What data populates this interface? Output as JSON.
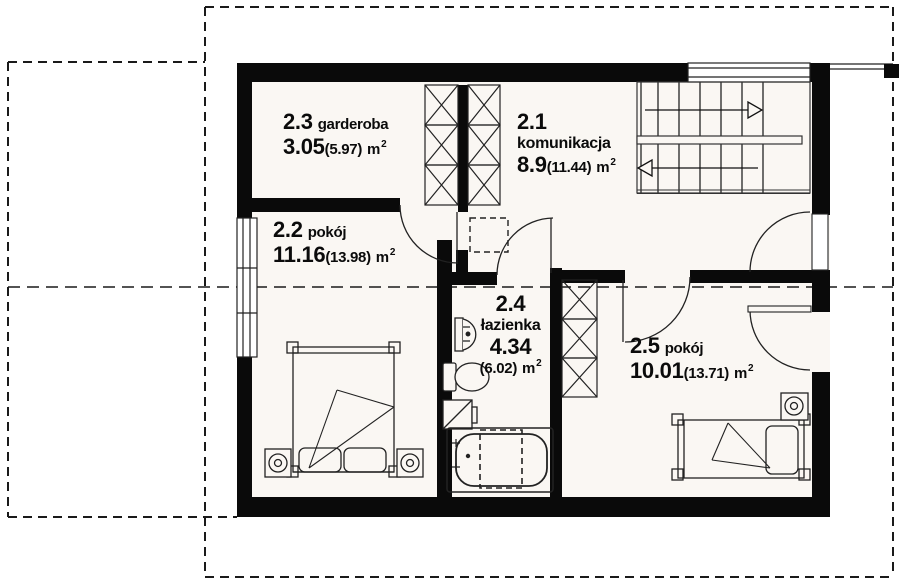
{
  "plan": {
    "title": "first floor plan",
    "unit": {
      "base": "m",
      "sup": "2"
    },
    "rooms": [
      {
        "number": "2.3",
        "name": "garderoba",
        "area": "3.05",
        "area_total": "(5.97)"
      },
      {
        "number": "2.1",
        "name": "komunikacja",
        "area": "8.9",
        "area_total": "(11.44)"
      },
      {
        "number": "2.2",
        "name": "pokój",
        "area": "11.16",
        "area_total": "(13.98)"
      },
      {
        "number": "2.4",
        "name": "łazienka",
        "area": "4.34",
        "area_total": "(6.02)"
      },
      {
        "number": "2.5",
        "name": "pokój",
        "area": "10.01",
        "area_total": "(13.71)"
      }
    ],
    "colors": {
      "wall": "#0a0a0a",
      "line": "#222222",
      "paper": "#faf7f3"
    }
  }
}
